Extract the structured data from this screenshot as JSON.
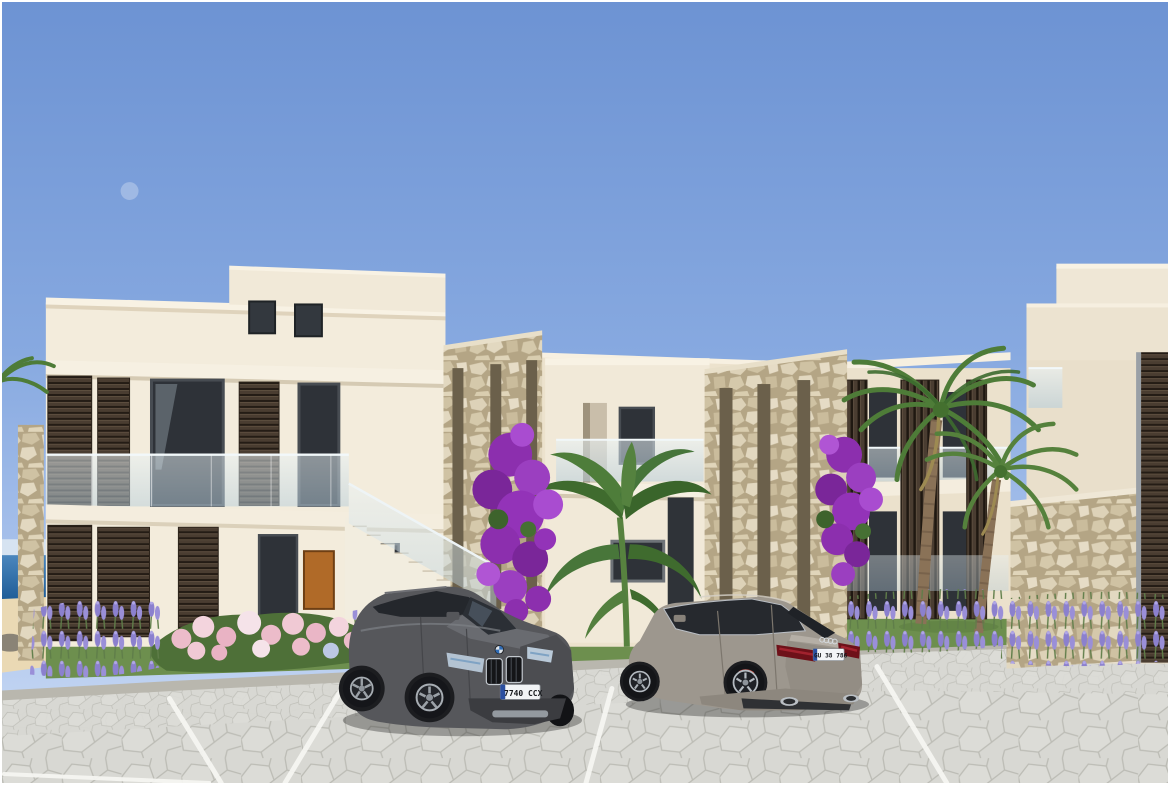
{
  "scene": {
    "kind": "3D architectural exterior rendering",
    "description": "Modern two-storey seaside apartment complex with cream facades, dark timber louvre shutters, rubble-stone feature pillars, glass balustrades and an external staircase; palm trees, purple bougainvillea, lavender and pink hydrangeas in the landscaping; cobblestone parking area in front with a grey SUV and a grey sedan; a strip of Mediterranean sea visible at the far left under a clear blue sky with a faint daytime moon."
  },
  "sky": {
    "top_color": "#6d93d3",
    "horizon_color": "#cfdef5",
    "moon_visible": true
  },
  "sea": {
    "color": "#2b6ba6",
    "position": "far left horizon"
  },
  "ground": {
    "pavement": "light grey interlocking cobblestone pavers",
    "markings": "white parking bay lines",
    "lawn_color": "#6d8f4e",
    "sand_path": "beach sand strip at far left"
  },
  "buildings": {
    "wall_color": "#f3ecdc",
    "trim_color": "#f8f2e4",
    "louvre_color": "#4a3d31",
    "stone_color": "#d8ccb0",
    "window_glass_color": "#2e3238",
    "balustrade_glass_color": "#cfe0ea",
    "accent_door_color": "#b06a28",
    "features": [
      "flat parapet roofs",
      "rooftop penthouse with two dark windows",
      "external staircase with glass balustrade",
      "two rubble-stone feature pillars with vertical slots",
      "horizontal louvre shutters on left block",
      "vertical louvre screens on right wing",
      "stone garden wall at far right",
      "orange timber entrance door"
    ]
  },
  "vehicles": [
    {
      "name": "grey-suv",
      "body_color": "#56575b",
      "view": "front three-quarter",
      "license_plate": "7740 CCX",
      "details": [
        "twin kidney grille",
        "round bonnet badge",
        "white plate with blue euro band"
      ]
    },
    {
      "name": "grey-sedan",
      "body_color": "#9d978e",
      "view": "rear three-quarter",
      "license_plate": "GU 38 786",
      "details": [
        "four-ring boot badge",
        "red tail lights",
        "twin exhaust tips",
        "white plate with blue euro band"
      ]
    }
  ],
  "landscaping": {
    "palm_trees": 2,
    "bougainvillea_color": "#9333b8",
    "lavender_color": "#8d82cf",
    "hydrangea_color": "#ecbcca",
    "banana_plant": true,
    "grass_color": "#6d8f4e"
  }
}
